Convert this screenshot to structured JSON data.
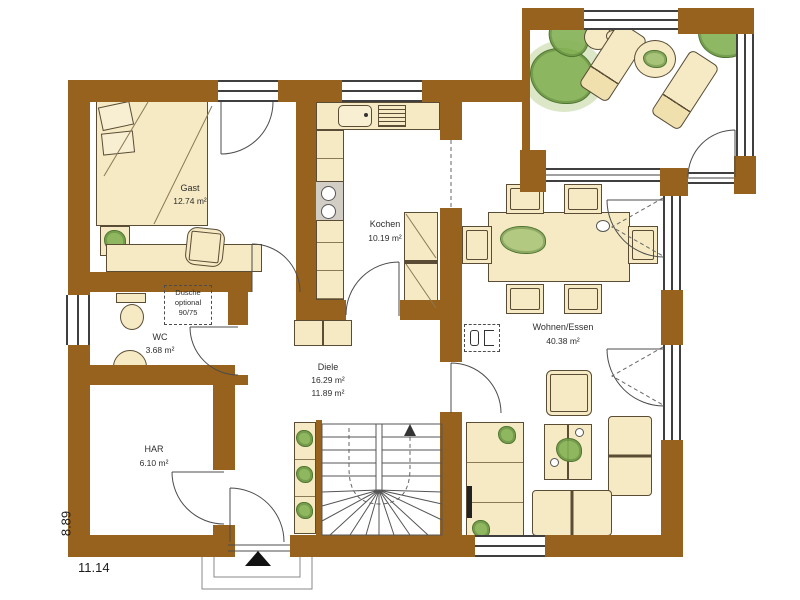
{
  "rooms": [
    {
      "id": "gast",
      "name": "Gast",
      "area": "12.74 m²"
    },
    {
      "id": "kochen",
      "name": "Kochen",
      "area": "10.19 m²"
    },
    {
      "id": "wc",
      "name": "WC",
      "area": "3.68 m²"
    },
    {
      "id": "har",
      "name": "HAR",
      "area": "6.10 m²"
    },
    {
      "id": "diele",
      "name": "Diele",
      "area": "16.29 m²",
      "area2": "11.89 m²"
    },
    {
      "id": "wohnen_essen",
      "name": "Wohnen/Essen",
      "area": "40.38 m²"
    }
  ],
  "annotations": {
    "dusche_line1": "Dusche",
    "dusche_line2": "optional",
    "dusche_line3": "90/75"
  },
  "dimensions": {
    "overall_width": "11.14",
    "overall_depth": "8.89"
  },
  "colors": {
    "wall": "#96621d",
    "furniture": "#f5eac3",
    "plant": "#86b257",
    "outline": "#5a4c35"
  },
  "furniture_icons": [
    "bed-icon",
    "pillow-icon",
    "desk-icon",
    "chair-icon",
    "plant-icon",
    "sink-icon",
    "drainer-icon",
    "stove-icon",
    "pantry-icon",
    "wardrobe-icon",
    "stairs-icon",
    "dining-table-icon",
    "lounger-icon",
    "terrace-table-icon",
    "toilet-icon",
    "washbasin-icon",
    "sofa-icon",
    "armchair-icon",
    "coffee-table-icon",
    "tv-icon",
    "fireplace-icon",
    "entrance-arrow-icon"
  ]
}
